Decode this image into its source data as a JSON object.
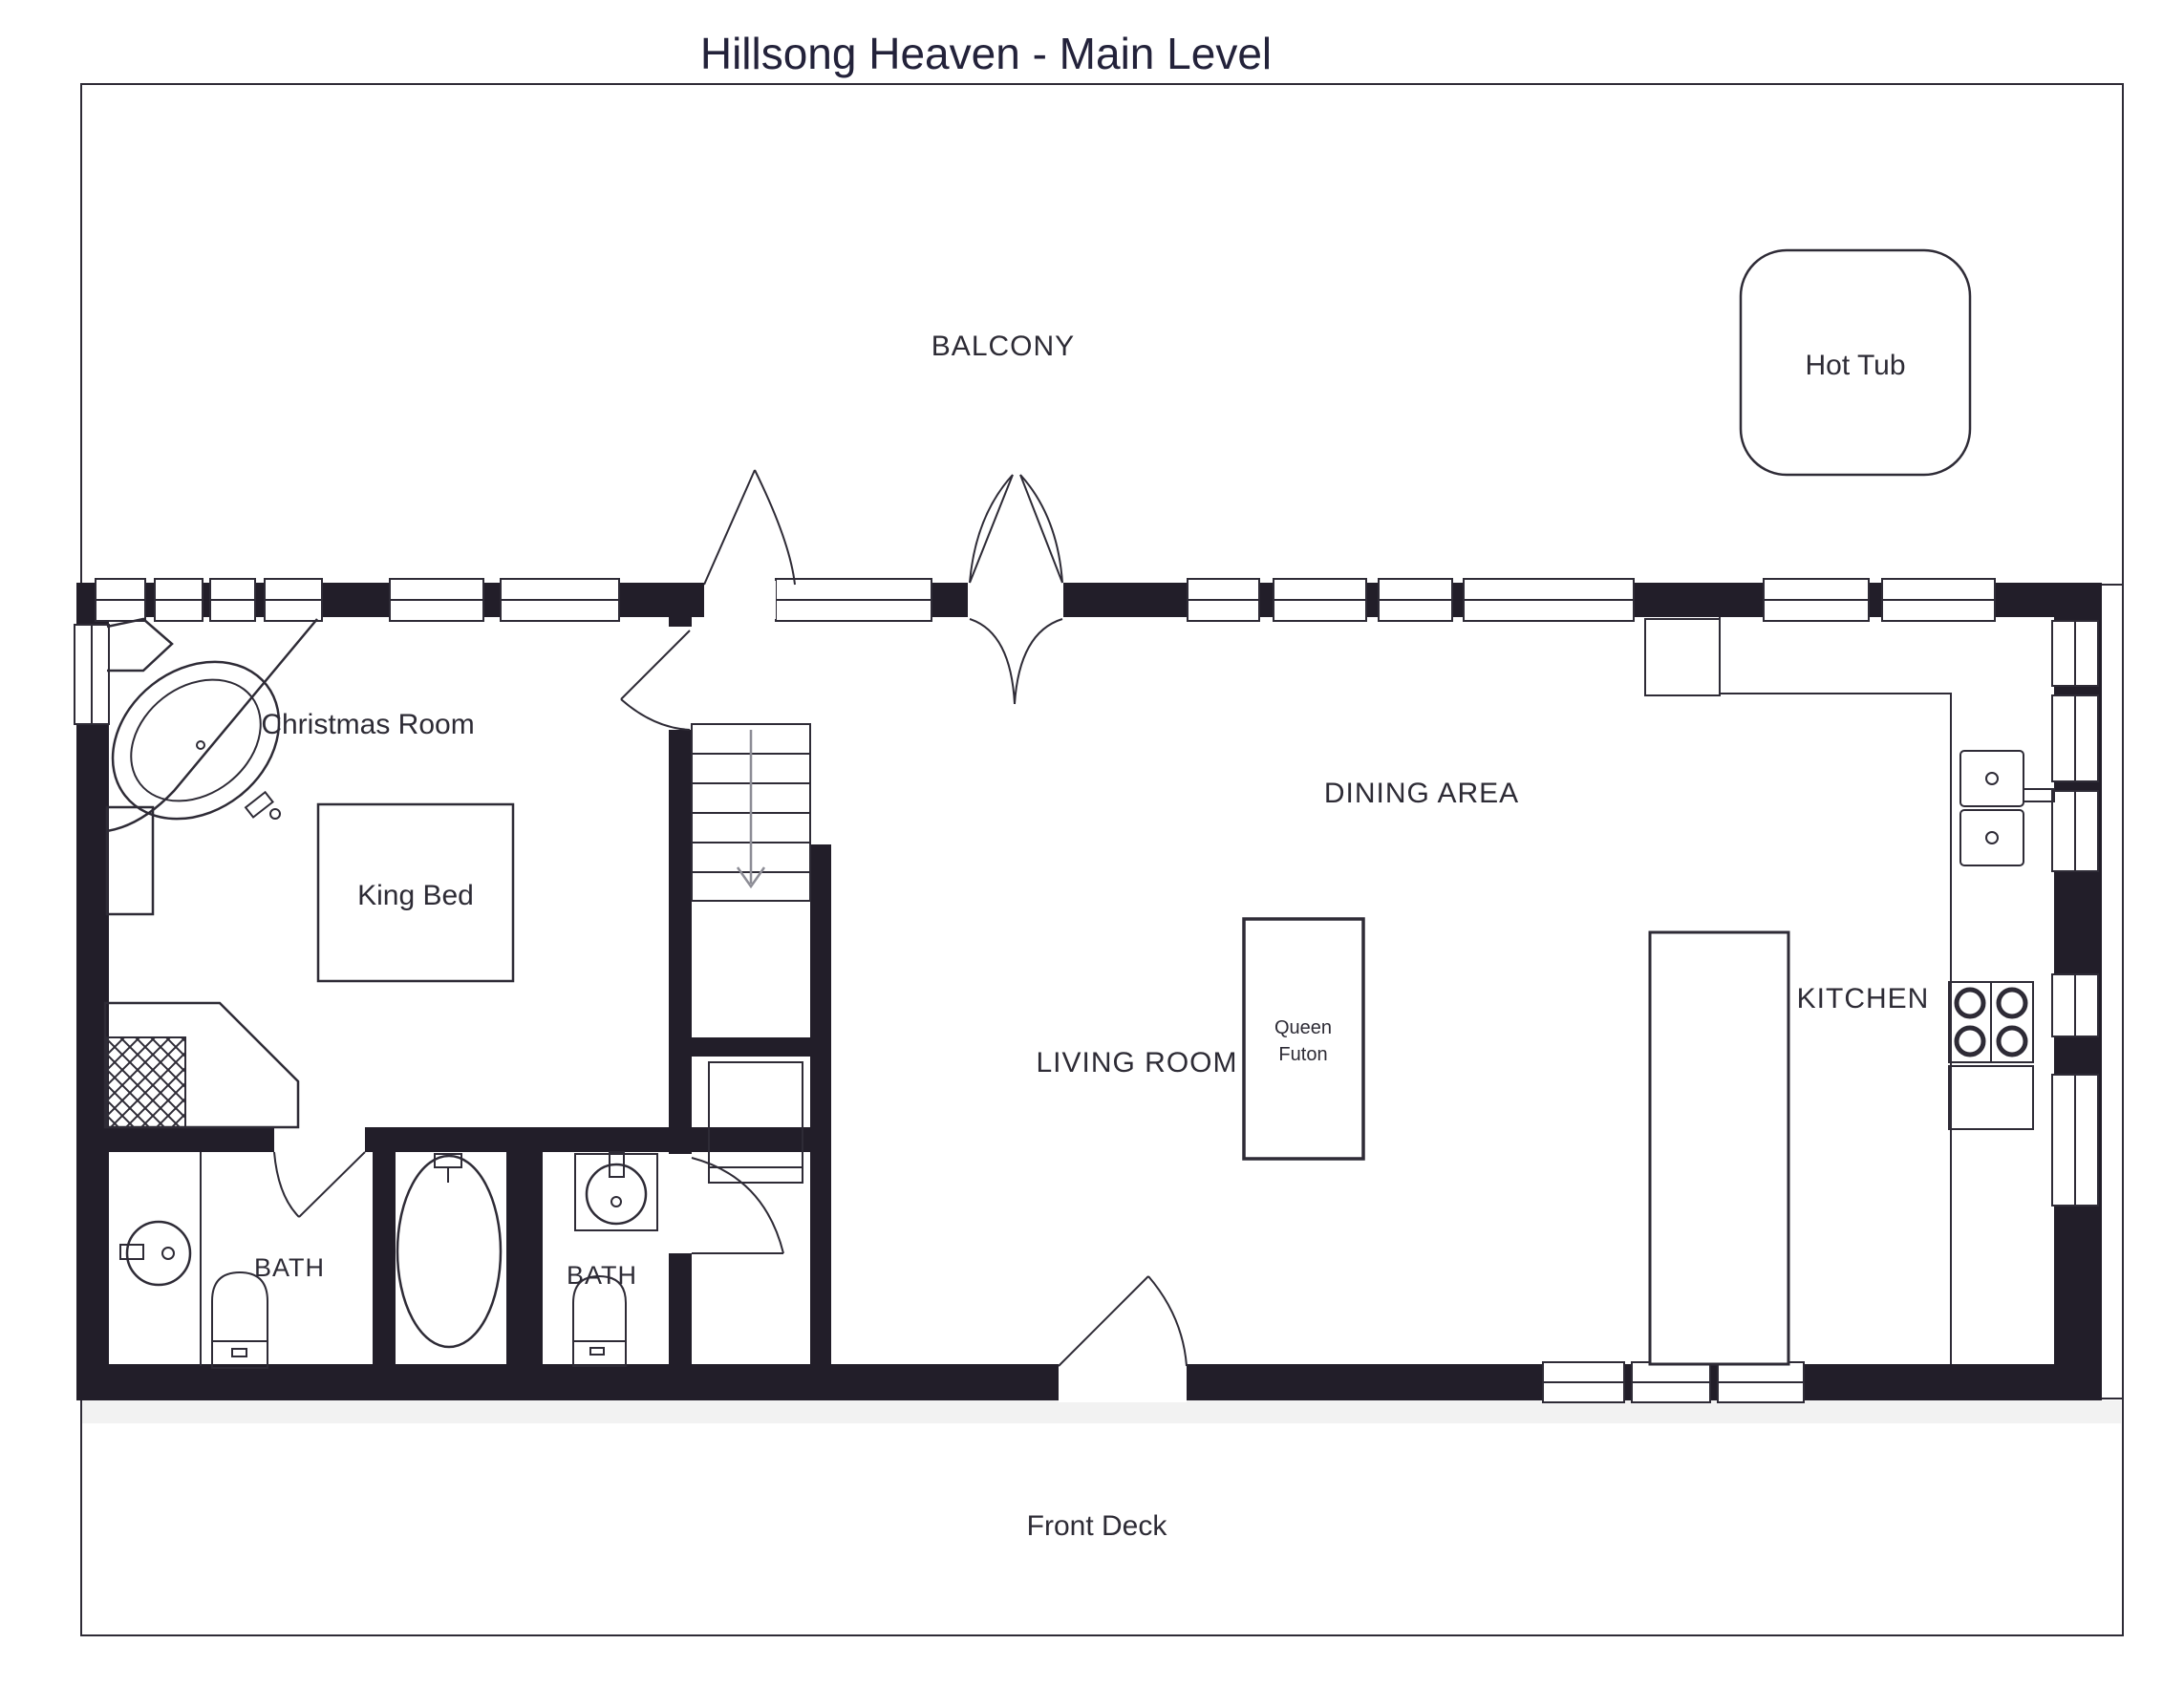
{
  "title": "Hillsong Heaven - Main Level",
  "labels": {
    "balcony": "BALCONY",
    "hot_tub": "Hot Tub",
    "christmas_room": "Christmas Room",
    "king_bed": "King Bed",
    "dining_area": "DINING AREA",
    "living_room": "LIVING ROOM",
    "queen_futon_line1": "Queen",
    "queen_futon_line2": "Futon",
    "kitchen": "KITCHEN",
    "bath_1": "BATH",
    "bath_2": "BATH",
    "front_deck": "Front Deck"
  },
  "colors": {
    "wall": "#221e29",
    "line": "#2e2b36",
    "text": "#2d2b35",
    "paper": "#ffffff"
  },
  "fixtures": [
    "hot-tub",
    "corner-garden-tub",
    "king-bed",
    "queen-futon",
    "staircase-down",
    "fireplace",
    "bathtub",
    "toilet",
    "bathroom-sink",
    "kitchen-sink",
    "stove",
    "refrigerator",
    "kitchen-island",
    "dishwasher",
    "closet"
  ]
}
